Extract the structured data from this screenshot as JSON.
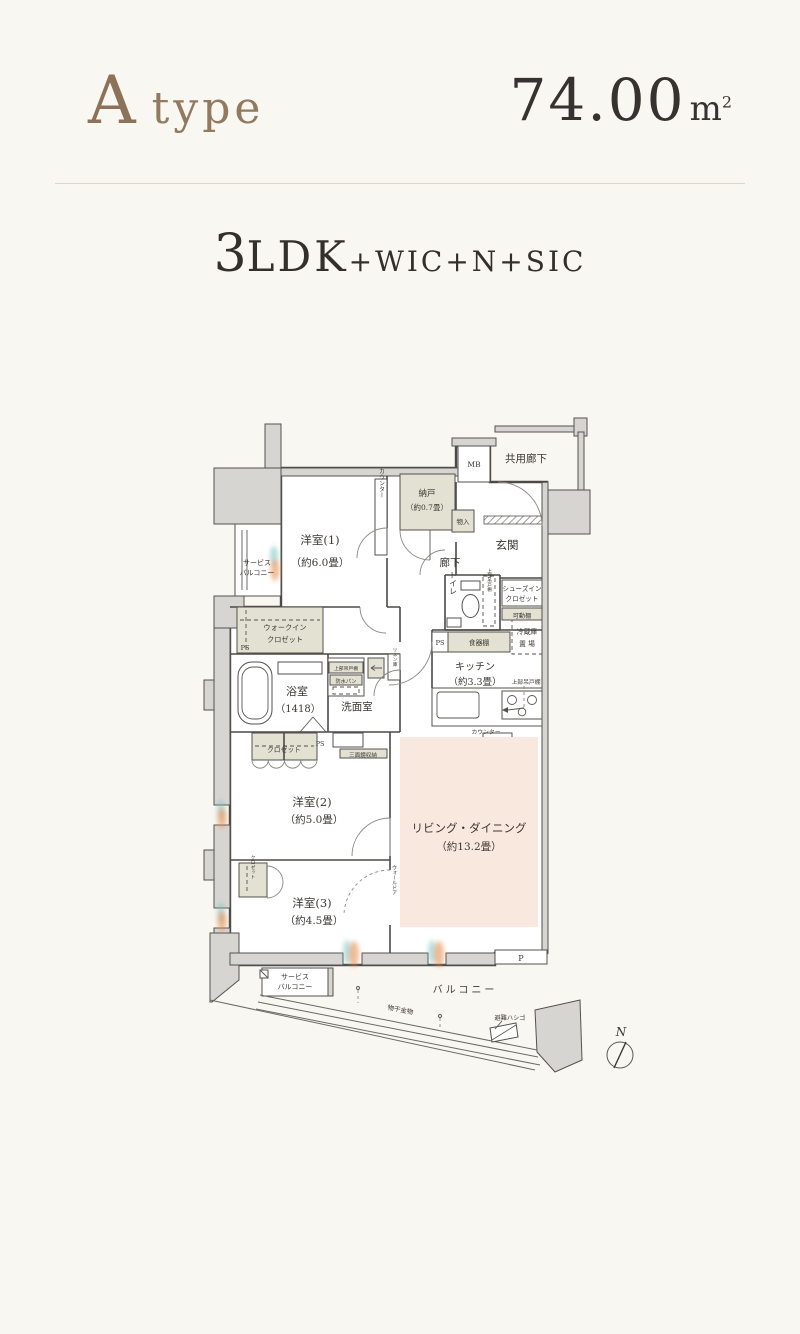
{
  "header": {
    "type_initial": "A",
    "type_word": "type",
    "area_value": "74.00",
    "area_unit": "m",
    "area_exponent": "2",
    "layout_number": "3",
    "layout_ldk": "LDK",
    "layout_extras": "+WIC+N+SIC"
  },
  "plan": {
    "labels": {
      "common_corridor": "共用廊下",
      "meter_box": "MB",
      "storage_room": "納戸",
      "storage_room_size": "（約0.7畳）",
      "closet_small": "物入",
      "counter_vertical": "カウンター",
      "bedroom1": "洋室(1)",
      "bedroom1_size": "（約6.0畳）",
      "hallway": "廊下",
      "entrance": "玄関",
      "toilet": "トイレ",
      "shoes_in_closet_1": "シューズイン",
      "shoes_in_closet_2": "クロゼット",
      "movable_shelf": "可動棚",
      "upper_cabinet_toilet": "上部吊戸棚",
      "fridge_1": "冷蔵庫",
      "fridge_2": "置 場",
      "dish_cabinet": "食器棚",
      "ps_kitchen": "PS",
      "kitchen": "キッチン",
      "kitchen_size": "（約3.3畳）",
      "upper_cabinet_kitchen": "上部吊戸棚",
      "counter_kitchen": "カウンター",
      "wic_1": "ウォークイン",
      "wic_2": "クロゼット",
      "ps_left": "PS",
      "bathroom": "浴室",
      "bathroom_size": "（1418）",
      "upper_cabinet_laundry": "上部吊戸棚",
      "waterproof_pan": "防水パン",
      "washroom": "洗面室",
      "linen_cabinet": "リネン庫",
      "closet_bedroom2": "クロゼット",
      "ps_closet": "PS",
      "mirror_cabinet": "三面鏡収納",
      "bedroom2": "洋室(2)",
      "bedroom2_size": "（約5.0畳）",
      "living_dining": "リビング・ダイニング",
      "living_dining_size": "（約13.2畳）",
      "closet_bedroom3": "クロゼット",
      "bedroom3": "洋室(3)",
      "bedroom3_size": "（約4.5畳）",
      "wall_door": "ウォールドア",
      "service_balcony_top_1": "サービス",
      "service_balcony_top_2": "バルコニー",
      "service_balcony_bottom_1": "サービス",
      "service_balcony_bottom_2": "バルコニー",
      "balcony": "バルコニー",
      "laundry_hardware": "物干金物",
      "escape_ladder": "避難ハシゴ",
      "pillar_mark": "P",
      "north": "N"
    },
    "colors": {
      "background": "#f9f7f2",
      "accent_brown": "#8b7258",
      "wall_fill": "#d7d5d2",
      "line": "#4b4a47",
      "living_fill": "#f9e8dd",
      "cabinet_fill": "#e3e1d2",
      "glow_orange": "#e78f4f",
      "glow_teal": "#6fc2bd"
    }
  }
}
